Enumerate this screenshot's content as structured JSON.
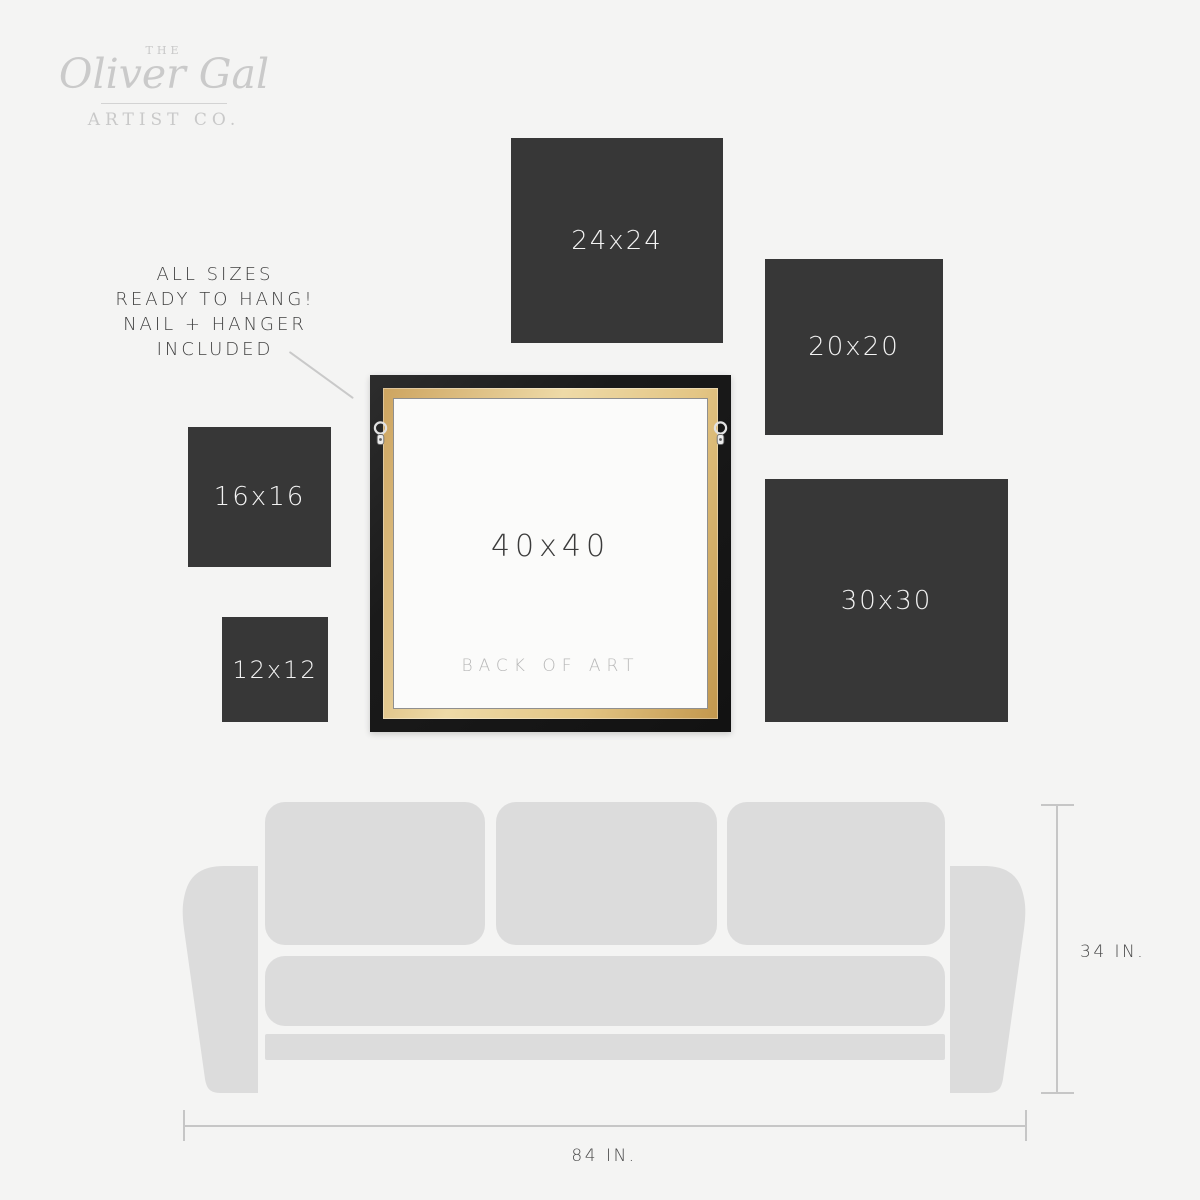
{
  "brand": {
    "the": "THE",
    "name": "Oliver Gal",
    "sub": "ARTIST CO."
  },
  "note": {
    "lines": [
      "ALL SIZES",
      "READY TO HANG!",
      "NAIL + HANGER",
      "INCLUDED"
    ]
  },
  "size_boxes": [
    {
      "label": "24x24"
    },
    {
      "label": "20x20"
    },
    {
      "label": "16x16"
    },
    {
      "label": "12x12"
    },
    {
      "label": "30x30"
    }
  ],
  "frame": {
    "size_label": "40x40",
    "back_label": "BACK OF ART"
  },
  "dimensions": {
    "couch_height": "34 IN.",
    "couch_width": "84 IN."
  },
  "colors": {
    "background": "#f4f4f3",
    "size_box": "#373737",
    "size_box_text": "#f3f3f3",
    "frame_black": "#1a1a1a",
    "frame_wood": "#e3c584",
    "canvas_back": "#fbfbfa",
    "couch": "#dcdcdc",
    "dimension_line": "#c6c6c6",
    "note_text": "#3f3f3f",
    "logo_gray": "#c9c9c9"
  }
}
